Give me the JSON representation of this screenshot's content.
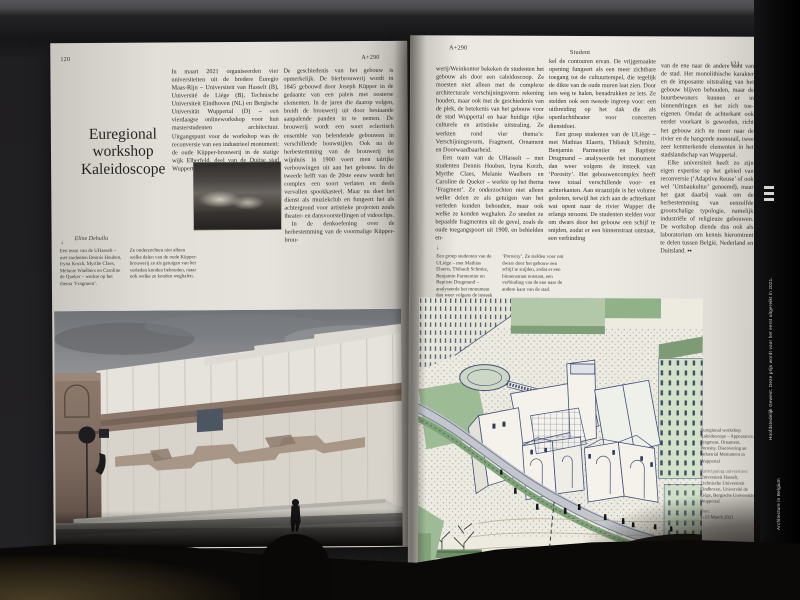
{
  "magazine": {
    "issue": "A+290",
    "section": "Student",
    "colors": {
      "paper": "#ece9e2",
      "ink": "#2c2b28",
      "illustration_green": "#9dbb94",
      "illustration_ink": "#42507a",
      "table": "#7a673e",
      "spine": "#0a0a0b"
    }
  },
  "left_page": {
    "page_number": "120",
    "header_right": "A+290",
    "title_lines": {
      "l1": "Euregional",
      "l2": "workshop",
      "l3": "Kaleidoscope"
    },
    "author": "Eline Dehullu",
    "caption_marker": "↓",
    "caption_col1": "Een team van de UHasselt – met studenten Dennis Houben, Iryna Korzh, Myrthe Claes, Melanie Waelbers en Caroline de Queker – werkte op het thema ‘Fragment’.",
    "caption_col2": "Ze onderzochten niet alleen welke delen van de oude Küpper-brouwerij ze als getuigen van het verleden konden behouden, maar ook welke ze konden weghalen.",
    "column1_p1": "In maart 2021 organiseerden vier universiteiten uit de bredere Euregio Maas-Rijn – Universiteit van Hasselt (B), Université de Liège (B), Technische Universiteit Eindhoven (NL) en Bergische Universität Wuppertal (D) – een vierdaagse onlineworkshop voor hun masterstudenten architectuur. Uitgangspunt voor de workshop was de reconversie van een industrieel monument: de oude Küpper-brouwerij in de statige wijk Elberfeld, deel van de Duitse stad Wuppertal.",
    "column2_p1": "De geschiedenis van het gebouw is opmerkelijk. De bierbrouwerij wordt in 1845 gebouwd door Joseph Küpper in de gedaante van een paleis met oosterse elementen. In de jaren die daarop volgen, breidt de brouwerij uit door bestaande aanpalende panden in te nemen. De brouwerij wordt een soort eclectisch ensemble van belendende gebouwen in verschillende bouwstijlen. Ook na de herbestemming van de brouwerij tot wijnhuis in 1900 voert men talrijke verbouwingen uit aan het gebouw. In de tweede helft van de 20ste eeuw wordt het complex een soort verlaten en deels vervallen spookkasteel. Maar nu doet het dienst als muziekclub en fungeert het als achtergrond voor artistieke projecten zoals theater- en dansvoorstellingen of videoclips.",
    "column2_p2": "In de denkoefening over de herbestemming van de voormalige Küpper-brou-"
  },
  "right_page": {
    "page_number": "121",
    "header_left": "A+290",
    "header_center": "Student",
    "column1_p1": "werij/Weinkontor bekeken de studenten het gebouw als door een caleidoscoop. Ze moesten niet alleen met de complexe architecturale verschijningsvorm rekening houden, maar ook met de geschiedenis van de plek, de betekenis van het gebouw voor de stad Wuppertal en haar huidige rijke culturele en artistieke uitstraling. Ze werkten rond vier thema’s: Verschijningsvorm, Fragment, Ornament en Doorwaadbaarheid.",
    "column1_p2": "Een team van de UHasselt – met studenten Dennis Houben, Iryna Korzh, Myrthe Claes, Melanie Waelbers en Caroline de Queker – werkte op het thema ‘Fragment’. Ze onderzochten niet alleen welke delen ze als getuigen van het verleden konden behouden, maar ook welke ze konden weghalen. Zo sneden ze bepaalde fragmenten uit de gevel, zoals de oude toegangspoort uit 1900, en behielden en-",
    "column2_p1": "kel de contouren ervan. De vrijgemaakte opening fungeert als een meer zichtbare toegang tot de cultuurtempel, die tegelijk de dikte van de oude muren laat zien. Door iets weg te halen, benadrukken ze iets. Ze stelden ook een tweede ingreep voor: een uitbreiding op het dak die als openluchttheater voor concerten dienstdoet.",
    "column2_p2": "Een groep studenten van de ULiège – met Mathias Elaerts, Thibault Schmitz, Benjamin Parmentier en Baptiste Drugmand – analyseerde het monument dan weer volgens de insteek van ‘Porosity’. Het gebouwencomplex heeft twee totaal verschillende voor- en achterkanten. Aan straatzijde is het volume gesloten, terwijl het zich aan de achterkant wat opent naar de rivier Wupper die erlangs stroomt. De studenten stelden voor om dwars door het gebouw een schijf te snijden, zodat er een binnenstraat ontstaat, een verbinding",
    "column3_p1": "van de ene naar de andere kant van de stad. Het monolithische karakter en de imposante uitstraling van het gebouw blijven behouden, maar de buurtbewoners kunnen er in binnendringen en het zich toe-eigenen. Omdat de achterkant ook eerder voorkant is geworden, richt het gebouw zich nu meer naar de rivier en de hangende monorail, twee zeer kenmerkende elementen in het stadslandschap van Wuppertal.",
    "column3_p2": "Elke universiteit heeft zo zijn eigen expertise op het gebied van reconversie (‘Adaptive Reuse’ of ook wel ‘Umbaukultur’ genoemd), maar het gaat daarbij vaak om de herbestemming van eenzelfde grootschalige typologie, namelijk industriële of religieuze gebouwen. De workshop diende dus ook als laboratorium om kennis hieromtrent te delen tussen België, Nederland en Duitsland.",
    "end_mark": "▪▪",
    "caption_marker": "↓",
    "caption_col1": "Een groep studenten van de ULiège – met Mathias Elaerts, Thibault Schmitz, Benjamin Parmentier en Baptiste Drugmand – analyseerde het monument dan weer volgens de insteek van",
    "caption_col2": "‘Porosity’. Ze stelden voor om dwars door het gebouw een schijf te snijden, zodat er een binnenstraat ontstaat, een verbinding van de ene naar de andere kant van de stad.",
    "project_caption": {
      "title": "Euregional workshop Kaleidoscope – Appearance, Fragment, Ornament, Porosity. Discovering an Industrial Monument in Wuppertal",
      "participating_label": "Participating universities:",
      "universities": "Universiteit Hasselt, Technische Universiteit Eindhoven, Université de Liège, Bergische Universität Wuppertal",
      "date_label": "Date:",
      "date": "3–13 March 2021"
    }
  },
  "spine": {
    "text_top": "Hoofdstedelijk Gewest. Deze prijs wordt voor het eerst uitgereikt in 2021.",
    "text_mid": "Architecture in Belgium",
    "text_bottom": "urban.brussels"
  }
}
